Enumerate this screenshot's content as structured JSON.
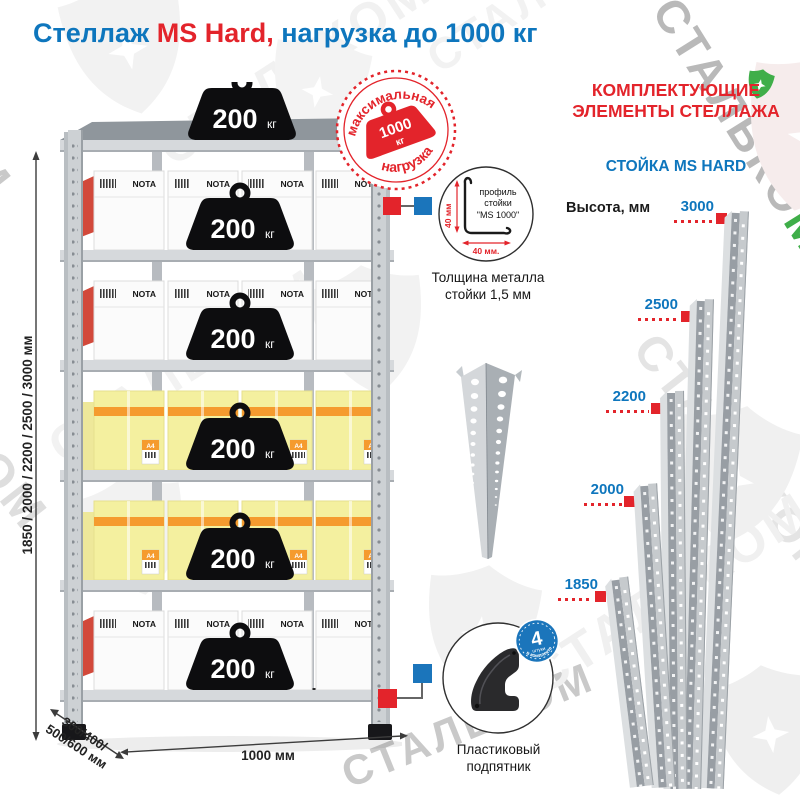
{
  "title": {
    "prefix": "Стеллаж",
    "highlight": " MS Hard,",
    "suffix": " нагрузка до 1000 кг"
  },
  "watermark": {
    "brand": "СТАЛЬКОМ",
    "brand_prefix": "СТАЛЬКО",
    "green_letter": "М"
  },
  "rack": {
    "weights": [
      {
        "value": "200",
        "unit": "кг"
      },
      {
        "value": "200",
        "unit": "кг"
      },
      {
        "value": "200",
        "unit": "кг"
      },
      {
        "value": "200",
        "unit": "кг"
      },
      {
        "value": "200",
        "unit": "кг"
      },
      {
        "value": "200",
        "unit": "кг"
      }
    ],
    "max_load": {
      "arc_top": "максимальная",
      "arc_bottom": "нагрузка",
      "value": "1000",
      "unit": "кг"
    },
    "box_brand": "NOTA",
    "box_a4": "A4",
    "dims": {
      "height": "1850 / 2000 / 2200 / 2500 / 3000 мм",
      "depth_l1": "300/400/",
      "depth_l2": "500/600 мм",
      "width": "1000 мм"
    }
  },
  "profile": {
    "dim_vertical": "40 мм",
    "dim_horizontal": "40 мм.",
    "label_l1": "профиль",
    "label_l2": "стойки",
    "label_l3": "\"MS 1000\"",
    "caption_l1": "Толщина металла",
    "caption_l2": "стойки 1,5 мм"
  },
  "foot": {
    "badge_value": "4",
    "badge_unit": "штуки",
    "badge_arc": "в комплекте",
    "caption_l1": "Пластиковый",
    "caption_l2": "подпятник"
  },
  "components": {
    "heading_l1": "КОМПЛЕКТУЮЩИЕ",
    "heading_l2": "ЭЛЕМЕНТЫ СТЕЛЛАЖА",
    "subheading": "СТОЙКА MS HARD",
    "height_label": "Высота, мм",
    "posts": [
      {
        "height": "3000"
      },
      {
        "height": "2500"
      },
      {
        "height": "2200"
      },
      {
        "height": "2000"
      },
      {
        "height": "1850"
      }
    ]
  },
  "colors": {
    "blue": "#0e76bd",
    "red": "#e3242b",
    "green": "#3fae49",
    "badge_blue": "#1b75bb"
  }
}
